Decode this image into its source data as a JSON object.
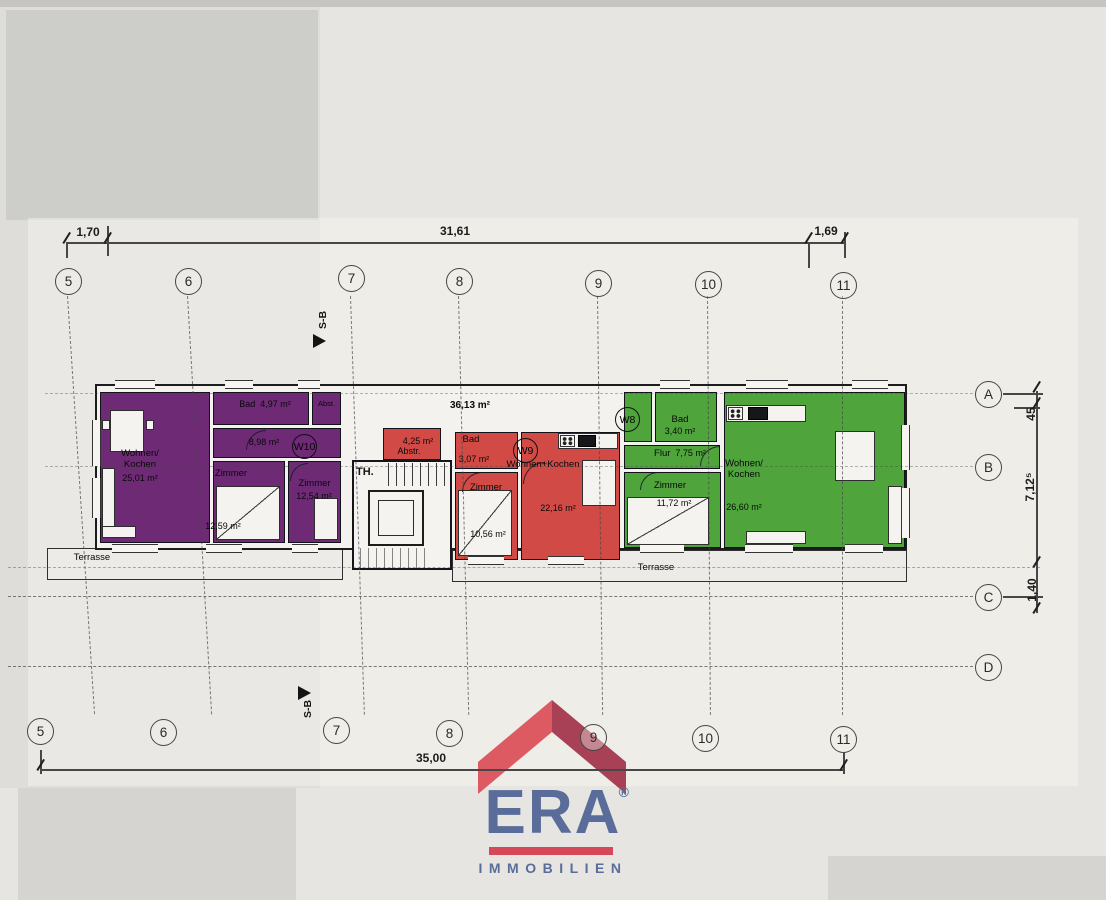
{
  "dims": {
    "top_left": "1,70",
    "top_main": "31,61",
    "top_right": "1,69",
    "bottom_total": "35,00",
    "right_upper": "45",
    "right_mid": "7,12⁵",
    "right_lower": "1,40"
  },
  "grid": {
    "cols": [
      "5",
      "6",
      "7",
      "8",
      "9",
      "10",
      "11"
    ],
    "rows": [
      "A",
      "B",
      "C",
      "D"
    ]
  },
  "marks": {
    "section": "S-B",
    "stairwell": "TH.",
    "roof_terrace_area": "36,13 m²",
    "terrace": "Terrasse"
  },
  "apartments": {
    "w10": {
      "id": "W10",
      "wohnen_name": "Wohnen/\nKochen",
      "wohnen_area": "25,01 m²",
      "bad_name": "Bad",
      "bad_area": "4,97 m²",
      "abst_name": "Abst.",
      "flur_area": "8,98 m²",
      "zimmer1_name": "Zimmer",
      "zimmer1_area": "12,59 m²",
      "zimmer2_name": "Zimmer",
      "zimmer2_area": "12,54 m²"
    },
    "w9": {
      "id": "W9",
      "abstr_name": "Abstr.",
      "abstr_area": "4,25 m²",
      "bad_name": "Bad",
      "bad_area": "3,07 m²",
      "wohnen_name": "Wohnen+Kochen",
      "wohnen_area": "22,16 m²",
      "zimmer_name": "Zimmer",
      "zimmer_area": "10,56 m²"
    },
    "w8": {
      "id": "W8",
      "bad_name": "Bad",
      "bad_area": "3,40 m²",
      "flur_name": "Flur",
      "flur_area": "7,75 m²",
      "zimmer_name": "Zimmer",
      "zimmer_area": "11,72 m²",
      "wohnen_name": "Wohnen/\nKochen",
      "wohnen_area": "26,60 m²"
    }
  },
  "colors": {
    "apartment_w10": "#6e2a75",
    "apartment_w9": "#d14a45",
    "apartment_w8": "#4fa43c",
    "logo_blue": "#5a6d9a",
    "logo_red": "#d6475a"
  },
  "logo": {
    "brand": "ERA",
    "registered": "®",
    "subtitle": "IMMOBILIEN"
  }
}
